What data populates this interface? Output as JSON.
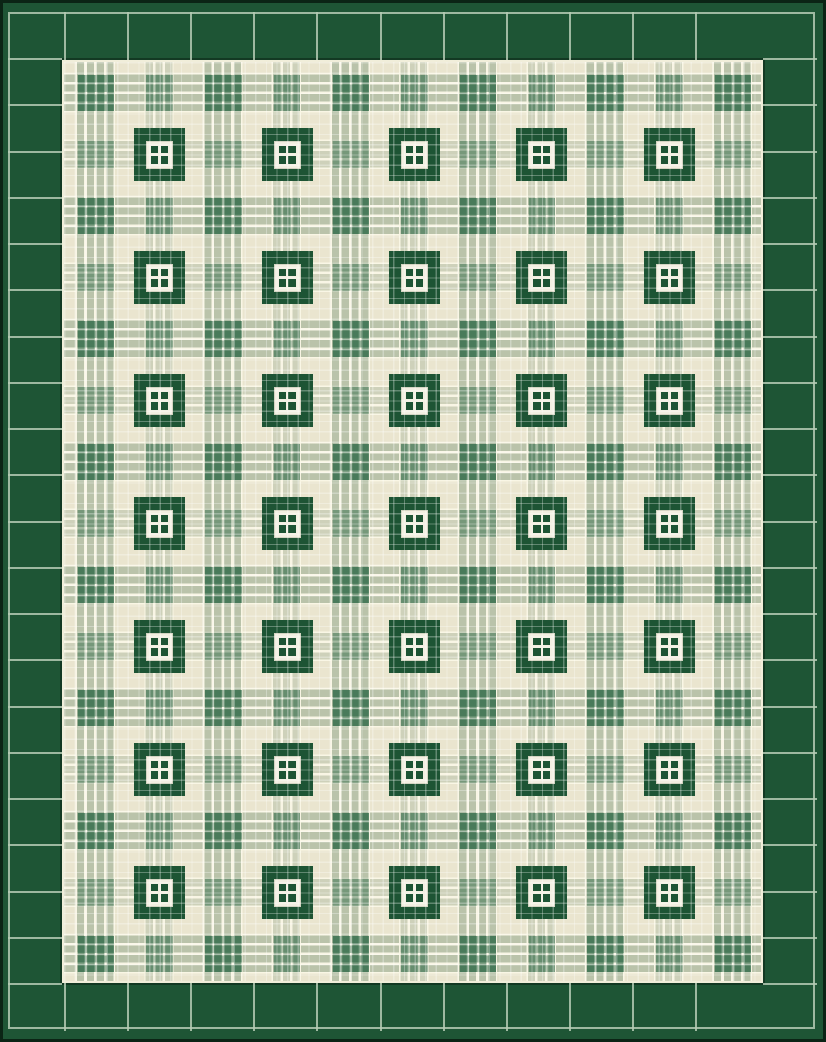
{
  "title": "Green and cream plaid quilt with dark green windowpane blocks and a dark green tiled border",
  "palette": {
    "edge": "#0b2415",
    "border_green": "#1e5535",
    "seam": "#b5cbb4",
    "cream": "#eae5cf",
    "pale": "rgba(250,247,230,0.95)",
    "pale_solid": "#f1eeda",
    "stripe_strong": "rgba(92,130,100,0.34)",
    "stripe_weak": "rgba(92,130,100,0.20)",
    "stripe_gap": "rgba(252,249,234,0.8)",
    "check_rgb": "32,97,61",
    "motif_green": "#1d5434",
    "motif_white": "#f2efe1"
  },
  "pattern": {
    "motif_columns": 5,
    "motif_rows": 7,
    "crossing_columns": 11,
    "crossing_rows": 15,
    "border_tiles_top": 13,
    "border_tiles_bottom": 13,
    "border_tiles_left": 21,
    "border_tiles_right": 21
  }
}
